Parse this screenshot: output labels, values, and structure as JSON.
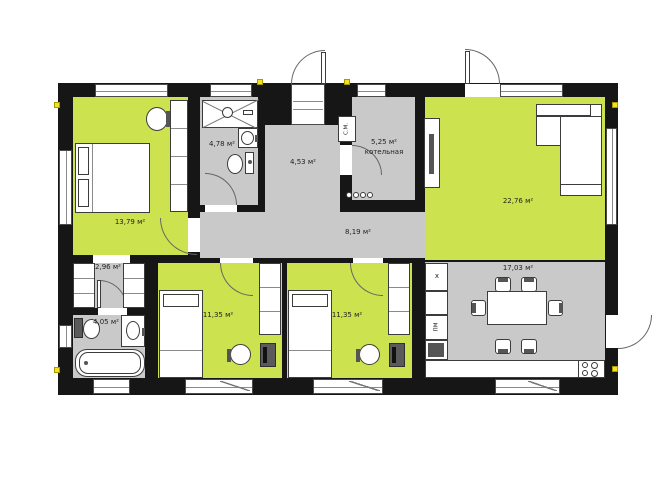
{
  "rooms": {
    "master_bedroom": {
      "area": "13,79 м²"
    },
    "shower_room": {
      "area": "4,78 м²"
    },
    "entry_hall": {
      "area": "4,53 м²"
    },
    "boiler_room": {
      "area": "5,25 м²",
      "name": "котельная"
    },
    "hallway": {
      "area": "8,19 м²"
    },
    "living_room": {
      "area": "22,76 м²"
    },
    "kitchen_dining": {
      "area": "17,03 м²"
    },
    "wardrobe": {
      "area": "2,96 м²"
    },
    "bathroom": {
      "area": "4,05 м²"
    },
    "bedroom_1": {
      "area": "11,35 м²"
    },
    "bedroom_2": {
      "area": "11,35 м²"
    }
  },
  "appliance_labels": {
    "washing_machine": "С.М.",
    "dishwasher": "ПМ",
    "fridge": "х"
  },
  "colors": {
    "room_green": "#cde24f",
    "floor_gray": "#c9c9c9",
    "wall_black": "#161616",
    "marker_yellow": "#f6e11c"
  }
}
